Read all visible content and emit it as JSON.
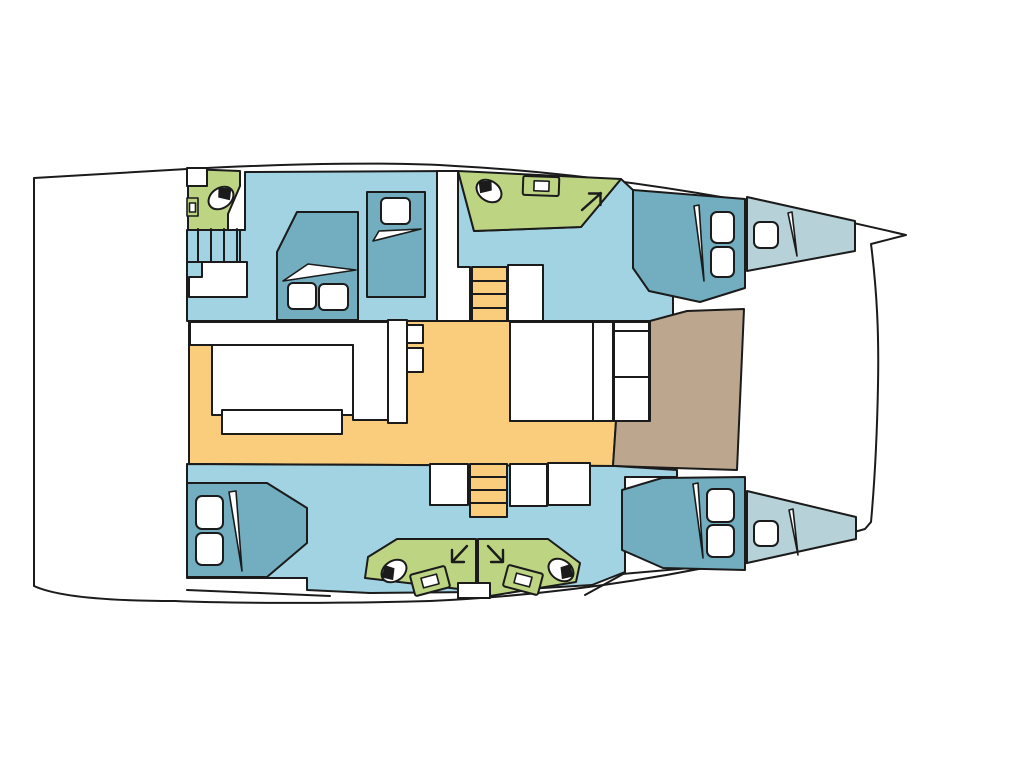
{
  "title": "catamaran-interior-deck-plan",
  "colors": {
    "background": "#ffffff",
    "deck": "#ffffff",
    "line": "#1b1b1b",
    "cabin_floor": "#a2d3e3",
    "bed": "#72aec0",
    "forepeak": "#b6d1d8",
    "head_green": "#bdd583",
    "salon_sole": "#f9cd7c",
    "cockpit_brown": "#bca78e",
    "furniture": "#ffffff"
  },
  "regions": {
    "hull": "hull-outline",
    "salon": "salon-sole",
    "cockpit": "forward-cockpit",
    "port_aft_head": "port-aft-head",
    "port_cabins": "port-hull-cabins",
    "starboard_cabins": "starboard-hull-cabins",
    "forward_head": "forward-head",
    "aft_heads": "aft-heads",
    "stairs": "companionway-steps",
    "forepeaks": "forepeak-berths"
  },
  "icons": [
    "toilet-icon",
    "sink-icon",
    "pillow-icon",
    "blanket-fold-icon",
    "steps-icon",
    "direction-arrow-icon"
  ]
}
